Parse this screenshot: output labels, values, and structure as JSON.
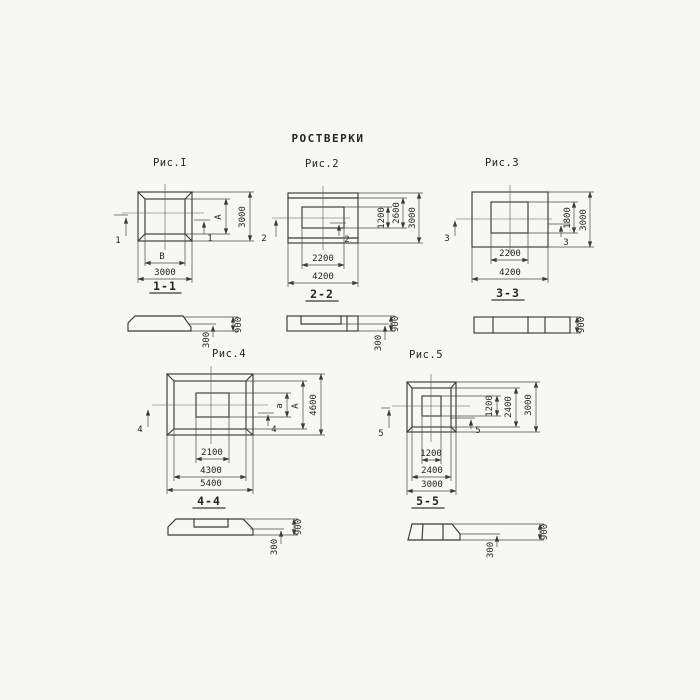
{
  "page": {
    "title": "РОСТВЕРКИ",
    "line_color": "#3a3a3a",
    "background": "#f7f7f4"
  },
  "fig1": {
    "title": "Рис.I",
    "marker": "1",
    "section_label": "1-1",
    "dim_inner_width": "В",
    "dim_inner_height": "А",
    "dim_bottom": "3000",
    "dim_right": "3000",
    "sec_height": "900",
    "sec_step": "300"
  },
  "fig2": {
    "title": "Рис.2",
    "marker": "2",
    "section_label": "2-2",
    "dim_bottom_inner": "2200",
    "dim_bottom_outer": "4200",
    "dim_right_inner": "1200",
    "dim_right_mid": "2600",
    "dim_right_outer": "3000",
    "sec_height": "900",
    "sec_step": "300"
  },
  "fig3": {
    "title": "Рис.3",
    "marker": "3",
    "section_label": "3-3",
    "dim_bottom_inner": "2200",
    "dim_bottom_outer": "4200",
    "dim_right_inner": "1800",
    "dim_right_outer": "3000",
    "sec_height": "900"
  },
  "fig4": {
    "title": "Рис.4",
    "marker": "4",
    "section_label": "4-4",
    "dim_bottom_inner": "2100",
    "dim_bottom_mid": "4300",
    "dim_bottom_outer": "5400",
    "dim_right_inner": "а",
    "dim_right_mid": "А",
    "dim_right_outer": "4600",
    "sec_height": "900",
    "sec_step": "300"
  },
  "fig5": {
    "title": "Рис.5",
    "marker": "5",
    "section_label": "5-5",
    "dim_bottom_inner": "1200",
    "dim_bottom_mid": "2400",
    "dim_bottom_outer": "3000",
    "dim_right_inner": "1200",
    "dim_right_mid": "2400",
    "dim_right_outer": "3000",
    "sec_height": "900",
    "sec_step": "300"
  }
}
